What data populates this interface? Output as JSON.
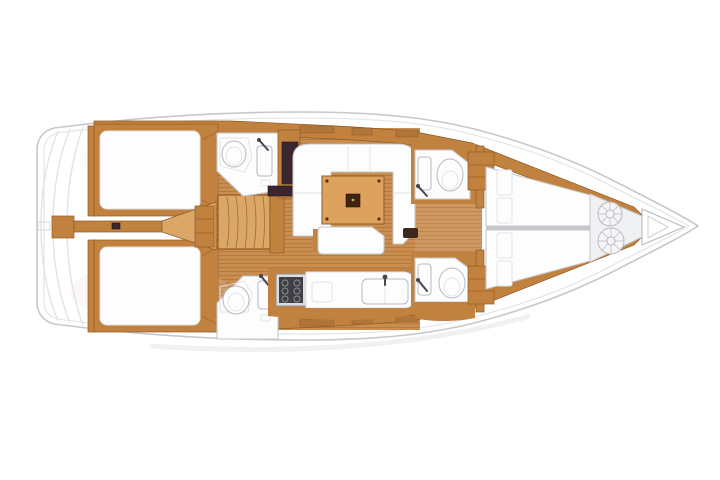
{
  "diagram": {
    "type": "floor-plan",
    "subject": "sailing-yacht-interior-top-view",
    "orientation": "bow-right-stern-left",
    "regions": [
      {
        "name": "stern-transom",
        "description": "curved transom / swim platform steps"
      },
      {
        "name": "aft-cabin-port",
        "description": "aft double berth cabin, port side"
      },
      {
        "name": "aft-cabin-starboard",
        "description": "aft double berth cabin, starboard side"
      },
      {
        "name": "companionway-stairs",
        "description": "entry steps between aft cabins"
      },
      {
        "name": "aft-head-port",
        "description": "aft bathroom with shower, sink and faucet"
      },
      {
        "name": "aft-head-starboard",
        "description": "aft bathroom with shower, sink and faucet"
      },
      {
        "name": "wardrobe",
        "description": "dark wardrobe locker beside port head"
      },
      {
        "name": "saloon-settee",
        "description": "U-shaped white settee"
      },
      {
        "name": "saloon-table",
        "description": "wooden saloon table with folding leaf"
      },
      {
        "name": "saloon-bench",
        "description": "white centre bench seat"
      },
      {
        "name": "galley",
        "description": "counter with stove and double sink"
      },
      {
        "name": "forward-head-port",
        "description": "forward bathroom with washbasin and toilet"
      },
      {
        "name": "forward-head-starboard",
        "description": "forward bathroom with washbasin and toilet"
      },
      {
        "name": "forward-berth-port",
        "description": "forward V-berth, port side"
      },
      {
        "name": "forward-berth-starboard",
        "description": "forward V-berth, starboard side"
      },
      {
        "name": "bow-locker",
        "description": "sail locker with two deck hatches"
      },
      {
        "name": "anchor-locker",
        "description": "triangular anchor locker at the bow"
      }
    ]
  },
  "colors": {
    "wood": "#c2823f",
    "wood-dark": "#8f5a24",
    "wood-light": "#daa767",
    "wood-floor": "#c98e4f",
    "wood-stripe": "#b07538",
    "table-wood": "#dca25e",
    "white": "#fdfdfe",
    "outline": "#c7c7cc",
    "soft": "#e2e2e8",
    "fix-line": "#b9b9c0",
    "dark-furniture": "#3a2530",
    "dark-brown": "#40240f",
    "steel-dark": "#46464d",
    "steel-mid": "#8e8e95",
    "pink-tint": "#f0d5d8",
    "locker-white": "#f4f5f7"
  }
}
